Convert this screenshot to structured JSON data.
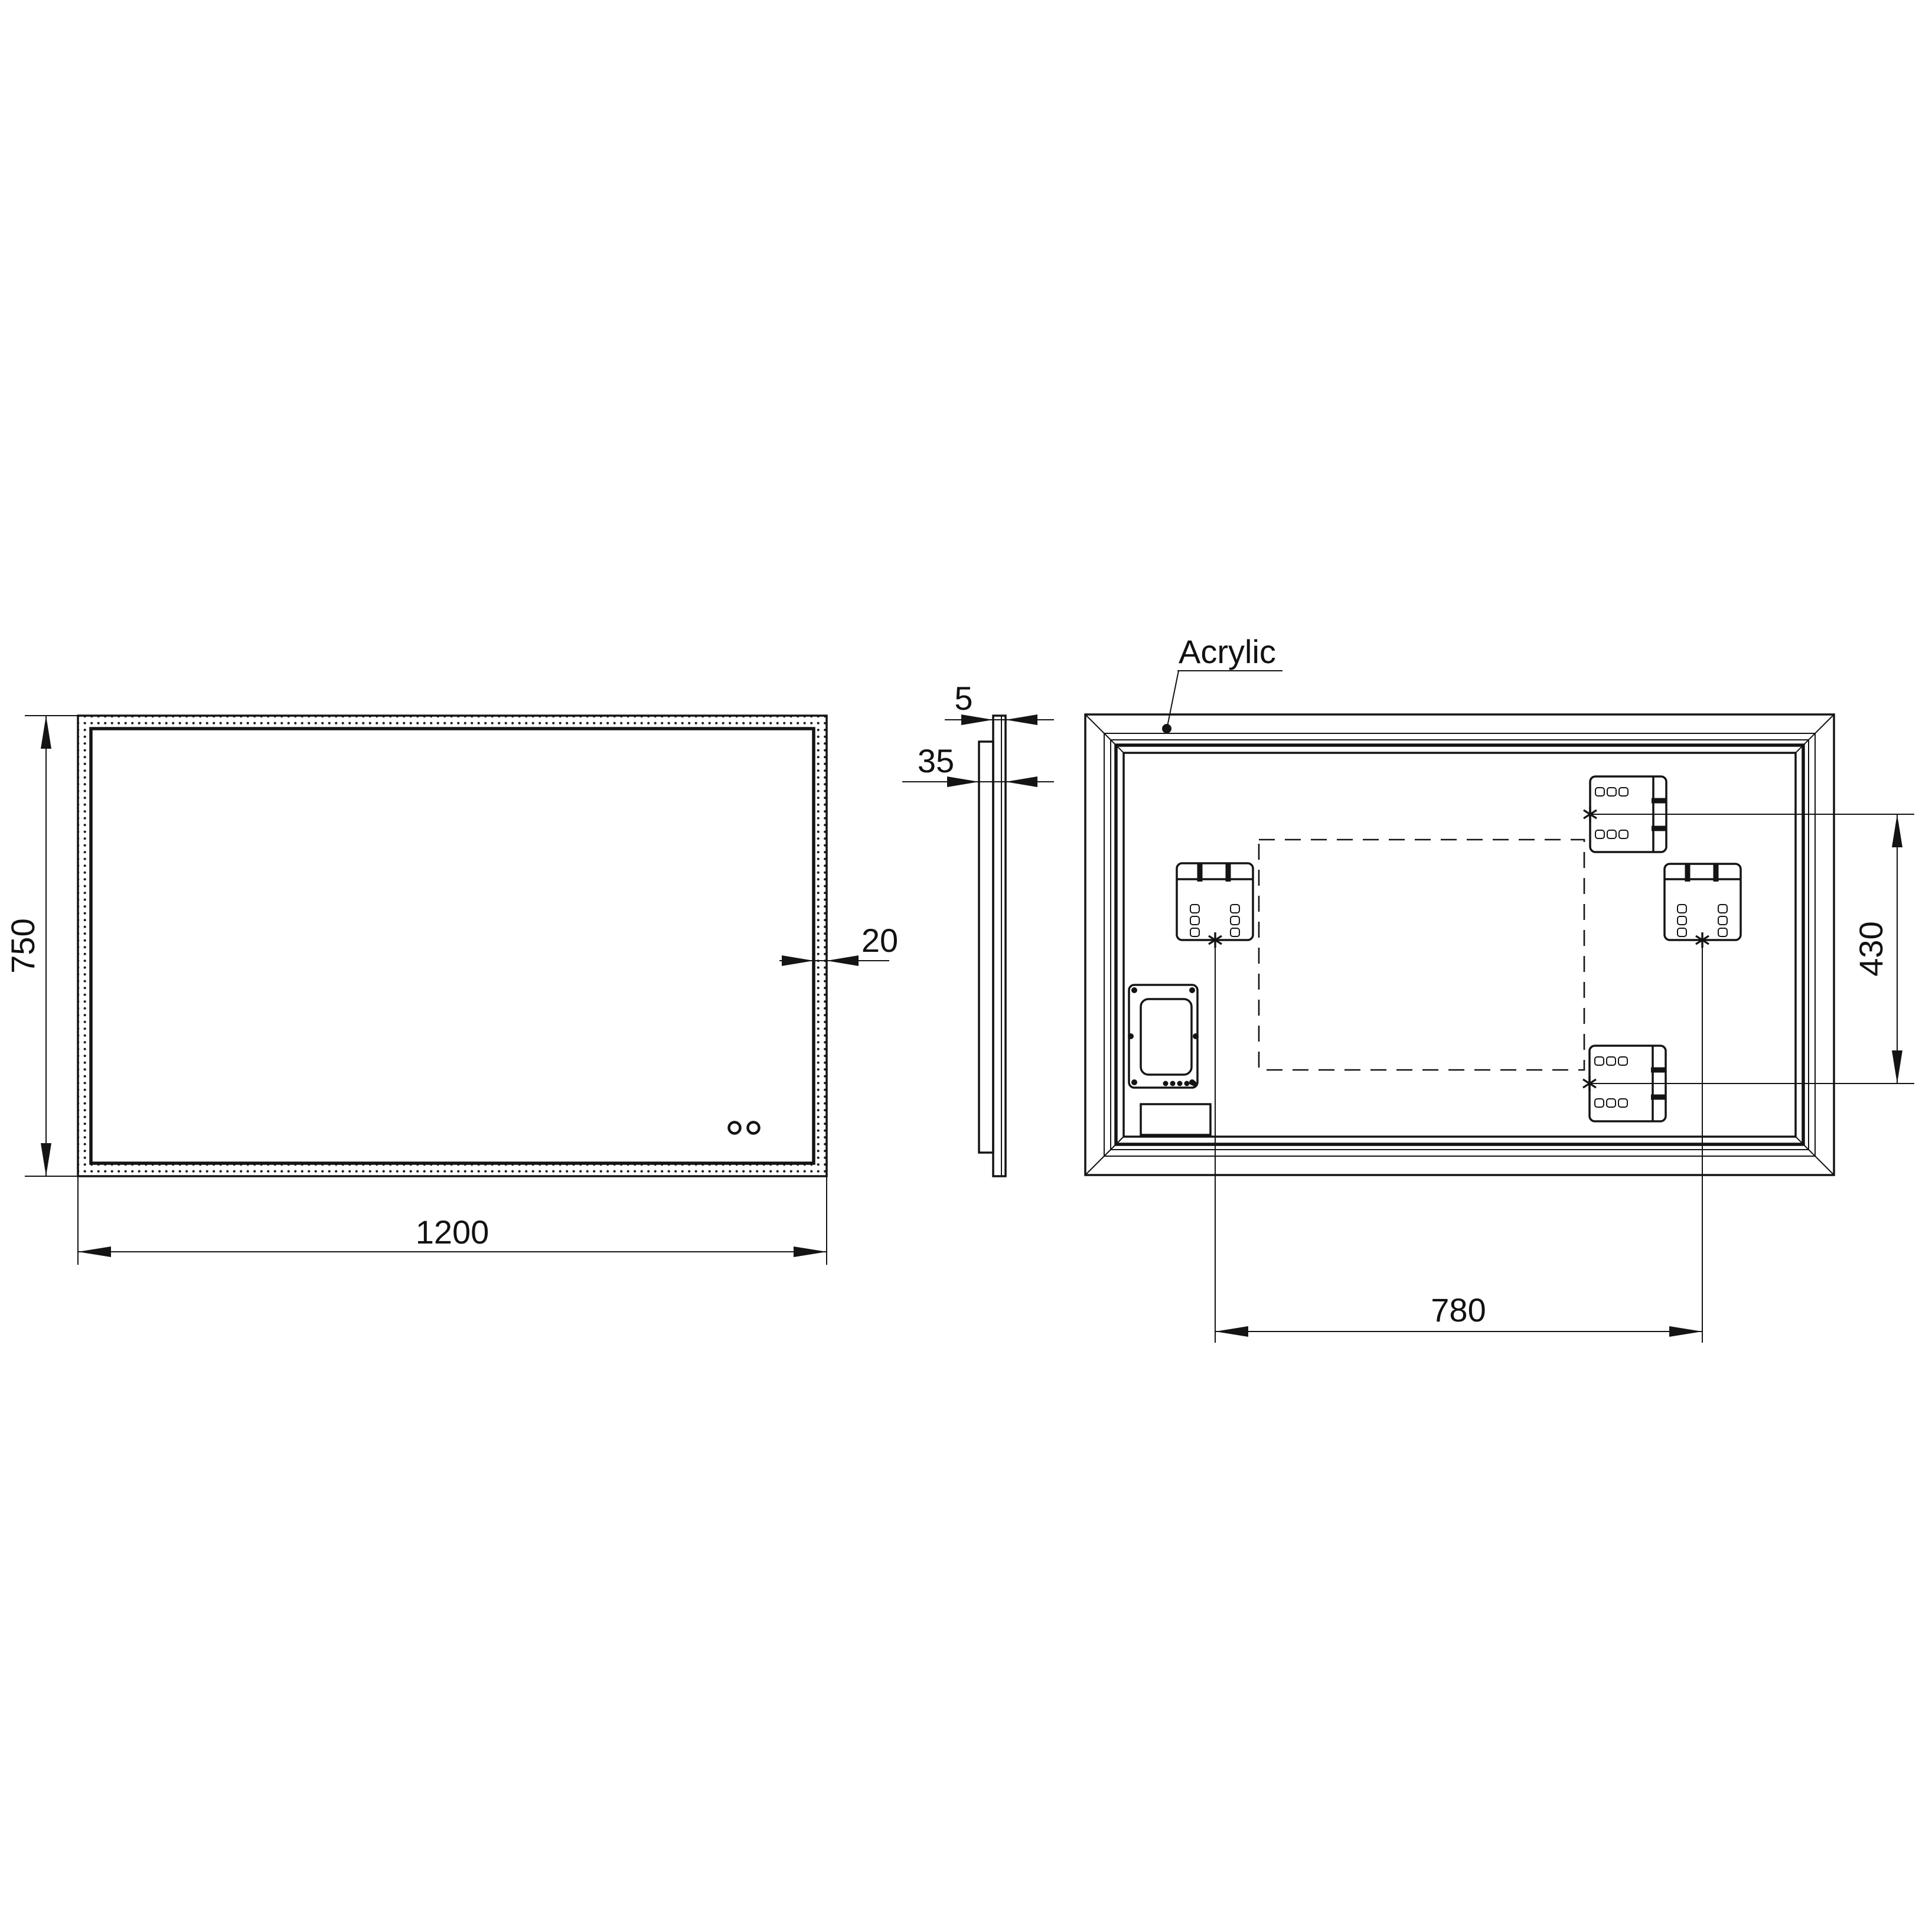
{
  "drawing": {
    "front_view": {
      "width_mm": "1200",
      "height_mm": "750",
      "led_border_mm": "20"
    },
    "side_view": {
      "front_panel_thickness_mm": "5",
      "overall_depth_mm": "35"
    },
    "back_view": {
      "material_callout": "Acrylic",
      "bracket_vertical_spacing_mm": "430",
      "bracket_horizontal_spacing_mm": "780"
    }
  }
}
